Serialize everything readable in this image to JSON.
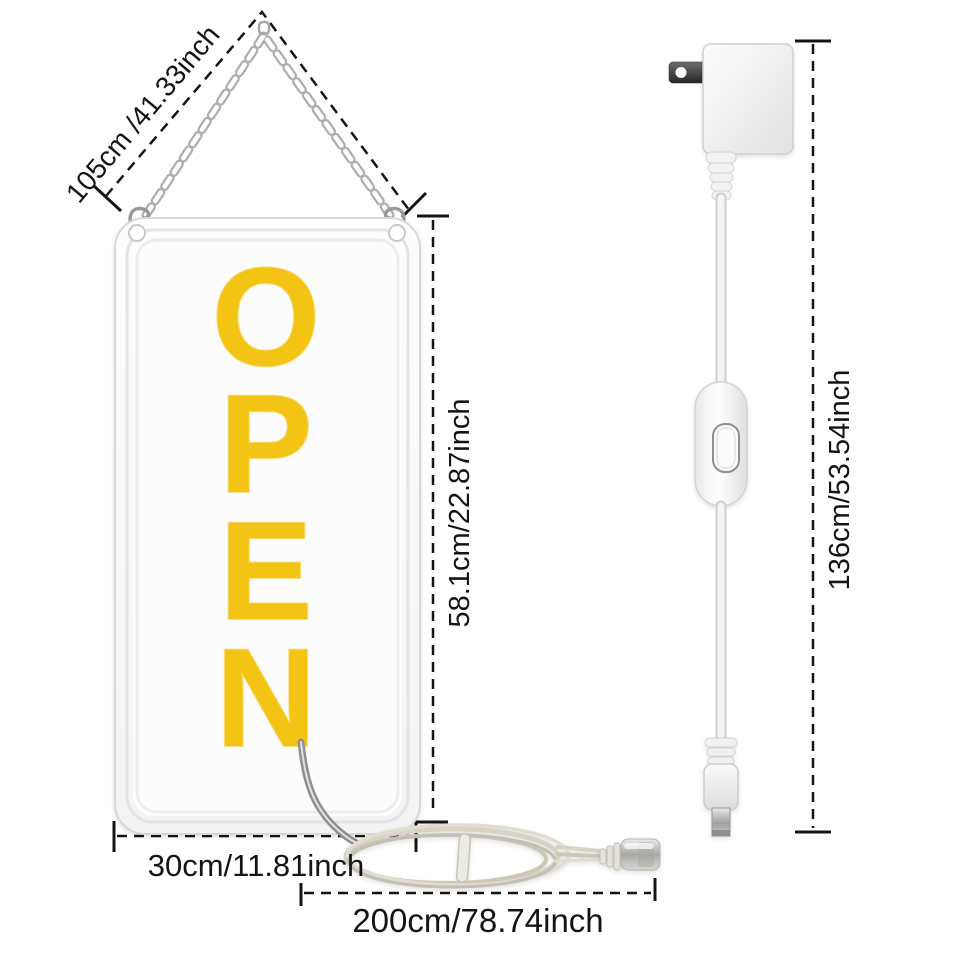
{
  "page": {
    "background": "#ffffff",
    "description": "Size diagram of hanging LED OPEN sign with power adapter"
  },
  "sign": {
    "text": "OPEN",
    "letters": [
      "O",
      "P",
      "E",
      "N"
    ],
    "letter_color": "#f4c414"
  },
  "measurements": {
    "chain": "105cm /41.33inch",
    "height": "58.1cm/22.87inch",
    "width": "30cm/11.81inch",
    "cord": "200cm/78.74inch",
    "adapter_cable": "136cm/53.54inch"
  },
  "colors": {
    "dimension_line": "#141414",
    "sign_letter": "#f4c414",
    "chain": "#b0aeaa",
    "cord_coil": "#d7d3c5",
    "adapter_body": "#f0f0f0",
    "plug_prong": "#2e2e2e"
  }
}
